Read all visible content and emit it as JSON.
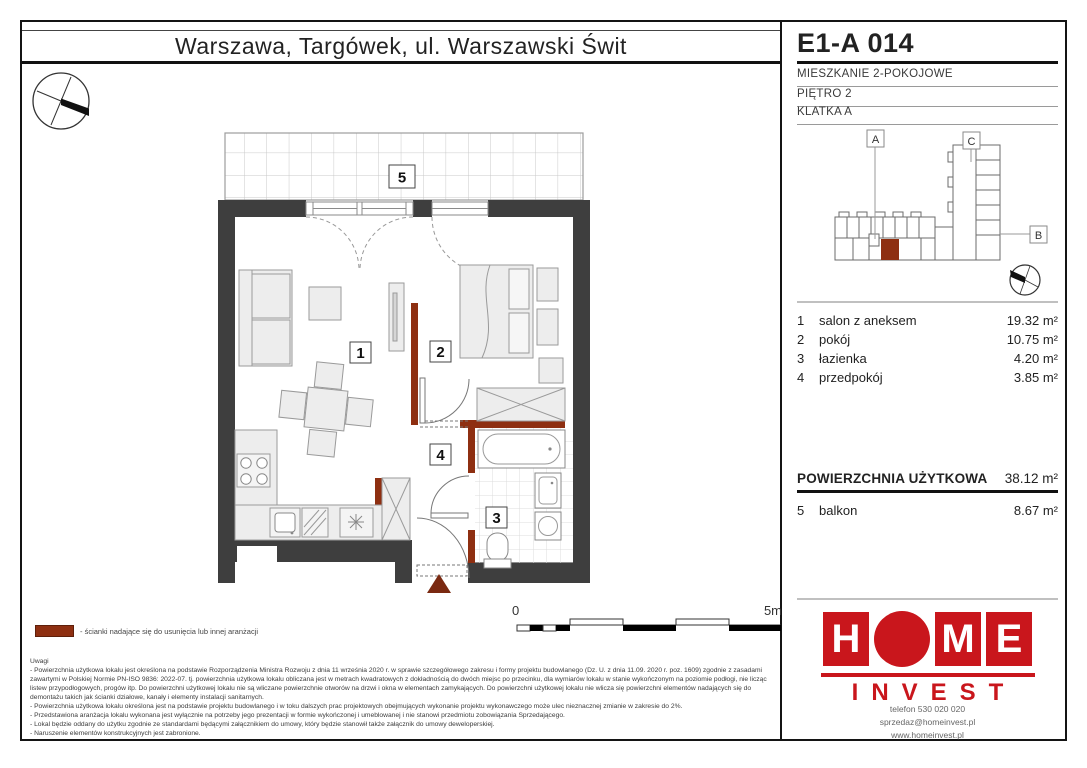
{
  "title": {
    "location": "Warszawa, Targówek, ul. Warszawski Świt"
  },
  "unit": {
    "id": "E1-A 014",
    "type": "MIESZKANIE 2-POKOJOWE",
    "floor": "PIĘTRO 2",
    "staircase": "KLATKA A"
  },
  "site": {
    "label_a": "A",
    "label_b": "B",
    "label_c": "C"
  },
  "plan": {
    "labels": {
      "r1": "1",
      "r2": "2",
      "r3": "3",
      "r4": "4",
      "r5": "5"
    }
  },
  "scale": {
    "start": "0",
    "end": "5m"
  },
  "legend": {
    "text": "- ścianki nadające się do usunięcia lub innej aranżacji"
  },
  "rooms": [
    {
      "no": "1",
      "name": "salon z aneksem",
      "area": "19.32 m²"
    },
    {
      "no": "2",
      "name": "pokój",
      "area": "10.75 m²"
    },
    {
      "no": "3",
      "name": "łazienka",
      "area": "4.20 m²"
    },
    {
      "no": "4",
      "name": "przedpokój",
      "area": "3.85 m²"
    }
  ],
  "total": {
    "label": "POWIERZCHNIA UŻYTKOWA",
    "area": "38.12 m²"
  },
  "balcony": {
    "no": "5",
    "name": "balkon",
    "area": "8.67 m²"
  },
  "brand": {
    "name": "HOME INVEST",
    "letter_h": "H",
    "letter_m": "M",
    "letter_e": "E",
    "invest": "INVEST",
    "phone": "telefon 530 020 020",
    "email": "sprzedaz@homeinvest.pl",
    "web": "www.homeinvest.pl"
  },
  "notes": {
    "title": "Uwagi",
    "body": "- Powierzchnia użytkowa lokalu jest określona na podstawie Rozporządzenia Ministra Rozwoju z dnia 11 września 2020 r. w sprawie szczegółowego zakresu i formy projektu budowlanego (Dz. U. z dnia 11.09. 2020 r. poz. 1609) zgodnie z zasadami zawartymi w Polskiej Normie PN-ISO 9836: 2022-07. tj. powierzchnia użytkowa lokalu obliczana jest w metrach kwadratowych z dokładnością do dwóch miejsc po przecinku, dla wymiarów lokalu w stanie wykończonym na poziomie podłogi, nie licząc listew przypodłogowych, progów itp. Do powierzchni użytkowej lokalu nie są wliczane powierzchnie otworów na drzwi i okna w elementach zamykających. Do powierzchni użytkowej lokalu nie wlicza się powierzchni elementów nadających się do demontażu takich jak ścianki działowe, kanały i elementy instalacji sanitarnych.\n- Powierzchnia użytkowa lokalu określona jest na podstawie projektu budowlanego i w toku dalszych prac projektowych obejmujących wykonanie projektu wykonawczego może ulec nieznacznej zmianie w zakresie do 2%.\n- Przedstawiona aranżacja lokalu wykonana jest wyłącznie na potrzeby jego prezentacji w formie wykończonej i umeblowanej i nie stanowi przedmiotu zobowiązania Sprzedającego.\n- Lokal będzie oddany do użytku zgodnie ze standardami będącymi załącznikiem do umowy, który będzie stanowił także załącznik do umowy deweloperskiej.\n- Naruszenie elementów konstrukcyjnych jest zabronione."
  },
  "colors": {
    "brand_red": "#c9161c",
    "partition_red": "#8e2f11",
    "wall_dark": "#3e3e3e"
  }
}
